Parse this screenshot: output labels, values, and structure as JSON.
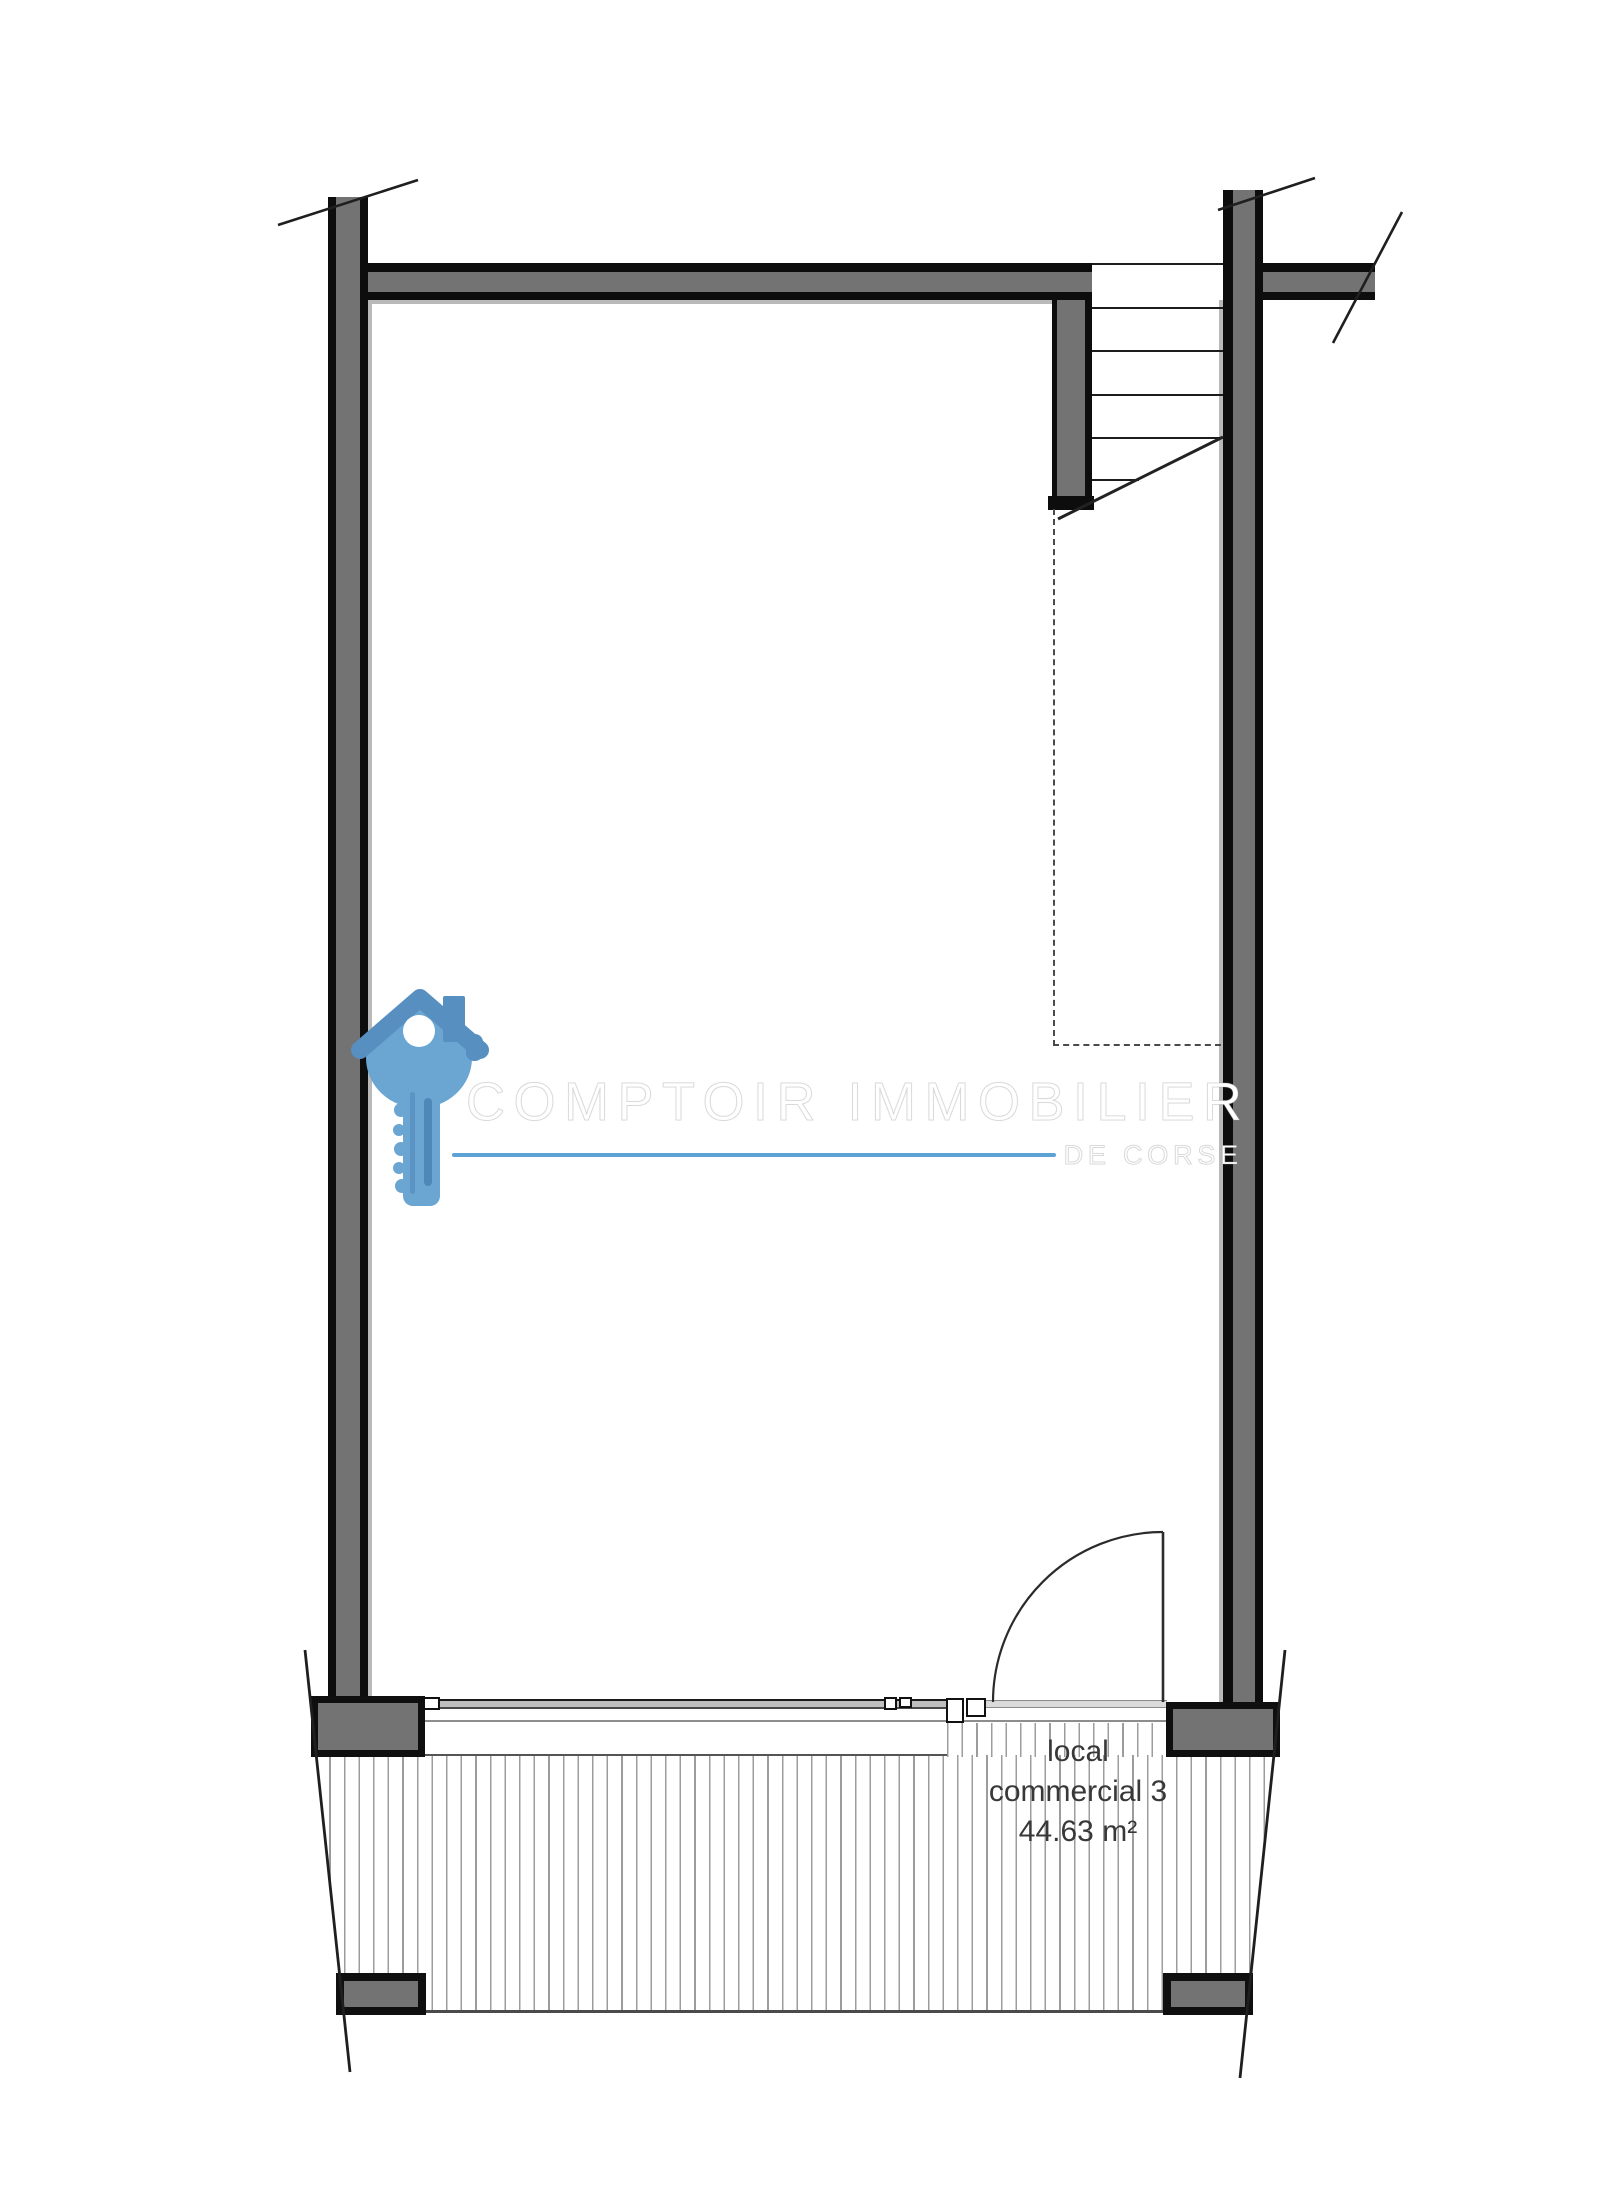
{
  "plan": {
    "room": {
      "lines": [
        "local",
        "commercial 3",
        "44.63 m²"
      ]
    },
    "watermark": {
      "title": "COMPTOIR IMMOBILIER",
      "subtitle": "DE CORSE",
      "accent_color": "#5da2d5",
      "key_body_color": "#6ba6d2",
      "key_roof_color": "#568fc0"
    },
    "colors": {
      "wall_fill": "#737373",
      "wall_outline": "#0d0d0d",
      "hatch_line": "#9c9c9c",
      "label_text": "#383838"
    }
  }
}
